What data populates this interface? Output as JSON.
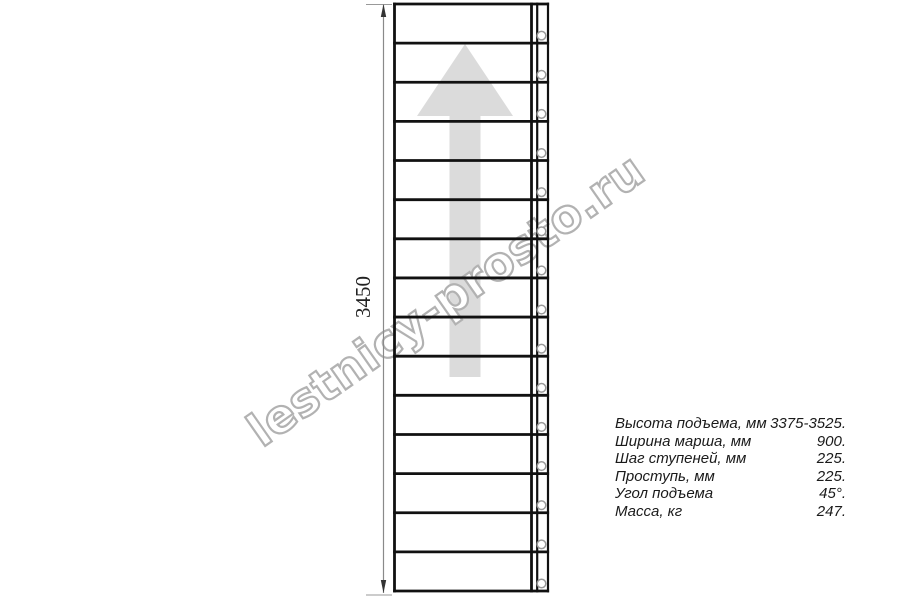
{
  "drawing": {
    "dimension_label": "3450",
    "watermark_text": "lestnicy-prosto.ru",
    "stair": {
      "treads": 15,
      "bolt_holes": 15,
      "arrow_icon": "up-arrow"
    }
  },
  "specs": {
    "rows": [
      {
        "label": "Высота подъема, мм",
        "value": "3375-3525."
      },
      {
        "label": "Ширина марша, мм",
        "value": "900."
      },
      {
        "label": "Шаг ступеней, мм",
        "value": "225."
      },
      {
        "label": "Проступь, мм",
        "value": "225."
      },
      {
        "label": "Угол подъема",
        "value": "45°."
      },
      {
        "label": "Масса, кг",
        "value": "247."
      }
    ]
  },
  "colors": {
    "line": "#111111",
    "arrow_fill": "#dbdbdb",
    "watermark_stroke": "#b2b2b2",
    "watermark_fill": "#ffffff",
    "dimension_line": "#8a8a8a",
    "dimension_arrow": "#333333",
    "hole_stroke": "#9a9a9a",
    "text": "#1a1a1a",
    "dim_text": "#222222"
  }
}
